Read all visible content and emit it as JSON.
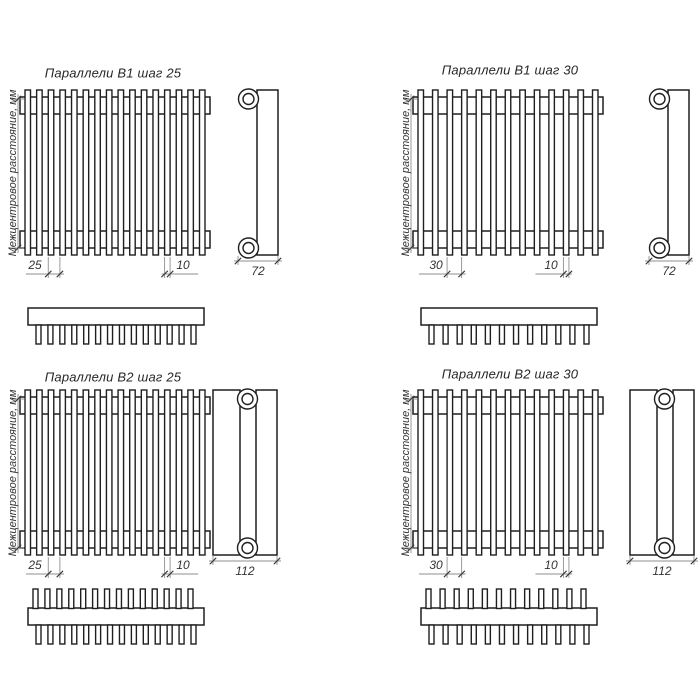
{
  "drawing": {
    "axis_label": "Межцентровое расстояние, мм",
    "panels": [
      {
        "id": "b1-step25",
        "title": "Параллели В1 шаг 25",
        "pitch": "25",
        "tube_width": "10",
        "depth": "72"
      },
      {
        "id": "b1-step30",
        "title": "Параллели В1 шаг 30",
        "pitch": "30",
        "tube_width": "10",
        "depth": "72"
      },
      {
        "id": "b2-step25",
        "title": "Параллели В2 шаг 25",
        "pitch": "25",
        "tube_width": "10",
        "depth": "112"
      },
      {
        "id": "b2-step30",
        "title": "Параллели В2 шаг 30",
        "pitch": "30",
        "tube_width": "10",
        "depth": "112"
      }
    ]
  }
}
